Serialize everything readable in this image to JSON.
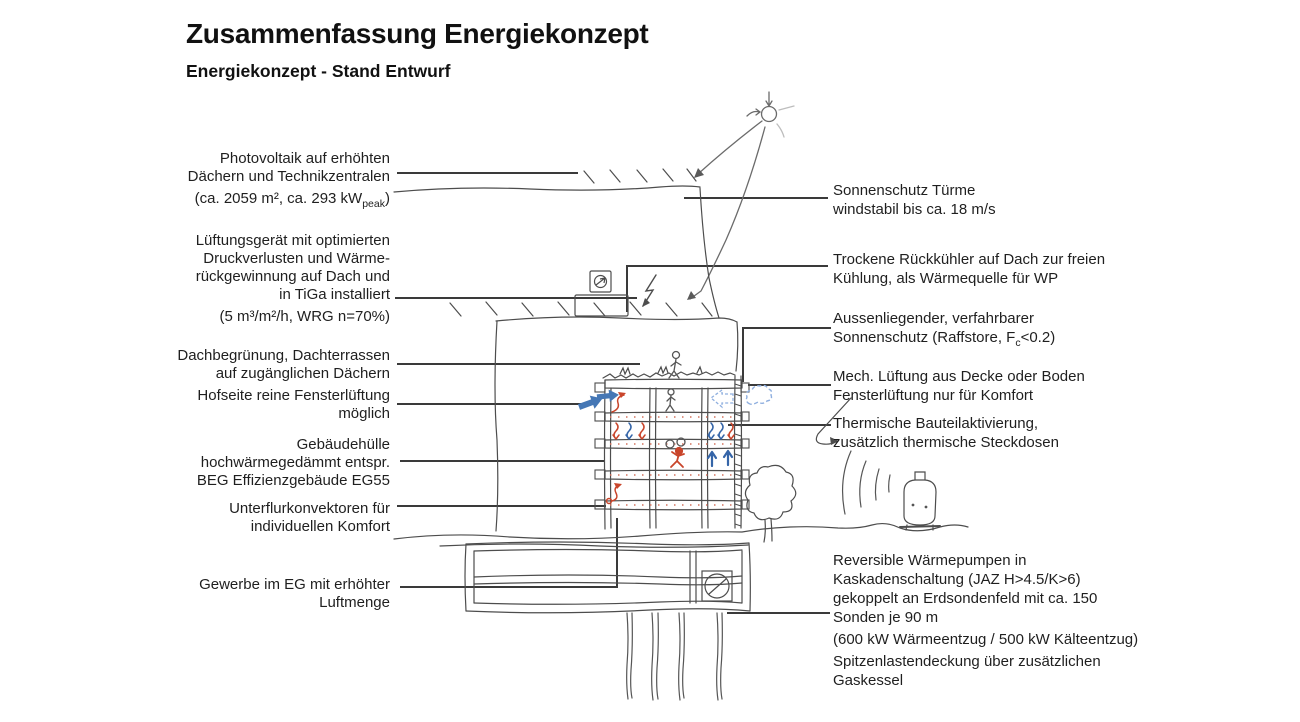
{
  "title": "Zusammenfassung Energiekonzept",
  "subtitle": "Energiekonzept - Stand Entwurf",
  "left_labels": [
    {
      "lines": [
        "Photovoltaik auf erhöhten",
        "Dächern und Technikzentralen"
      ],
      "sub_line": {
        "pre": "(ca. 2059 m², ca. 293 kW",
        "sub": "peak",
        "post": ")"
      }
    },
    {
      "lines": [
        "Lüftungsgerät mit optimierten",
        "Druckverlusten und Wärme-",
        "rückgewinnung auf Dach und",
        "in TiGa installiert",
        "(5 m³/m²/h, WRG n=70%)"
      ]
    },
    {
      "lines": [
        "Dachbegrünung, Dachterrassen",
        "auf zugänglichen Dächern"
      ]
    },
    {
      "lines": [
        "Hofseite reine Fensterlüftung",
        "möglich"
      ]
    },
    {
      "lines": [
        "Gebäudehülle",
        "hochwärmegedämmt entspr.",
        "BEG Effizienzgebäude EG55"
      ]
    },
    {
      "lines": [
        "Unterflurkonvektoren für",
        "individuellen Komfort"
      ]
    },
    {
      "lines": [
        "Gewerbe im EG mit erhöhter",
        "Luftmenge"
      ]
    }
  ],
  "right_labels": [
    {
      "lines": [
        "Sonnenschutz Türme",
        "windstabil bis ca. 18 m/s"
      ]
    },
    {
      "lines": [
        "Trockene Rückkühler auf Dach zur freien",
        "Kühlung, als Wärmequelle für WP"
      ]
    },
    {
      "lines": [
        "Aussenliegender, verfahrbarer"
      ],
      "sub_line": {
        "pre": "Sonnenschutz (Raffstore, F",
        "sub": "c",
        "post": "<0.2)"
      }
    },
    {
      "lines": [
        "Mech. Lüftung aus Decke oder Boden",
        "Fensterlüftung nur für Komfort"
      ]
    },
    {
      "lines": [
        "Thermische Bauteilaktivierung,",
        "zusätzlich thermische Steckdosen"
      ]
    },
    {
      "lines": [
        "Reversible Wärmepumpen in",
        "Kaskadenschaltung (JAZ H>4.5/K>6)",
        "gekoppelt an Erdsondenfeld mit ca. 150",
        "Sonden je 90 m",
        "(600 kW Wärmeentzug / 500 kW Kälteentzug)",
        "Spitzenlastendeckung über zusätzlichen",
        "Gaskessel"
      ]
    }
  ],
  "sketch": {
    "elements": [
      "sun",
      "photovoltaic-hatching",
      "tower-outline",
      "podium-outline",
      "ventilation-unit",
      "fan-symbol",
      "lightning-bolt",
      "building-cross-section",
      "green-roof",
      "thermally-activated-slabs",
      "raffstore-facade",
      "person-figures",
      "heat-and-air-arrows",
      "wind-cloud",
      "ground-line",
      "underground-garage",
      "heat-pump-symbol",
      "earth-probes",
      "tree",
      "gas-boiler",
      "sound-arcs"
    ]
  },
  "colors": {
    "text": "#1f1f1f",
    "leader_line": "#3a3a3a",
    "sketch_ink": "#4d4d4d",
    "heat_red": "#c9452b",
    "air_blue": "#4577b5",
    "air_blue_light": "#8fafdf"
  }
}
